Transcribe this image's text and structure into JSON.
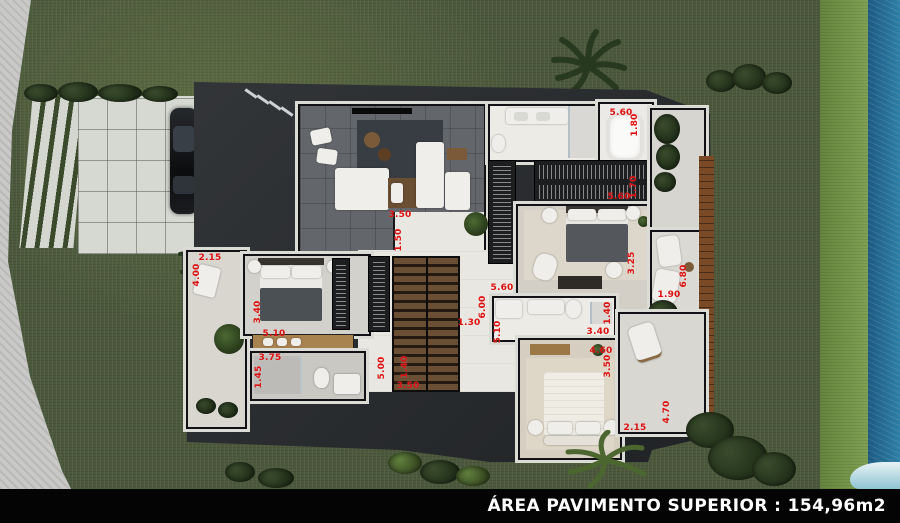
{
  "scene": {
    "description": "Top-down 3D architectural render of an upper-floor house plan with garden, driveway, parked car, wooden deck and pool"
  },
  "footer": {
    "area_label": "ÁREA PAVIMENTO SUPERIOR : 154,96m2"
  },
  "palette": {
    "grass": "#4c593c",
    "strip_green": "#7fa04f",
    "water": "#2e7fa6",
    "water_deep": "#1d5a82",
    "driveway": "#d6d8d2",
    "roof": "#26292c",
    "wood": "#7a4a26",
    "label_red": "#dd1111"
  },
  "dimensions": [
    {
      "label": "3.50",
      "x": 400,
      "y": 215,
      "vertical": false
    },
    {
      "label": "1.50",
      "x": 399,
      "y": 240,
      "vertical": true
    },
    {
      "label": "2.15",
      "x": 210,
      "y": 258,
      "vertical": false
    },
    {
      "label": "4.00",
      "x": 197,
      "y": 275,
      "vertical": true
    },
    {
      "label": "3.40",
      "x": 258,
      "y": 312,
      "vertical": true
    },
    {
      "label": "5.10",
      "x": 274,
      "y": 334,
      "vertical": false
    },
    {
      "label": "3.75",
      "x": 270,
      "y": 358,
      "vertical": false
    },
    {
      "label": "1.45",
      "x": 259,
      "y": 377,
      "vertical": true
    },
    {
      "label": "5.00",
      "x": 382,
      "y": 368,
      "vertical": true
    },
    {
      "label": "1.40",
      "x": 405,
      "y": 367,
      "vertical": true
    },
    {
      "label": "3.50",
      "x": 408,
      "y": 386,
      "vertical": false
    },
    {
      "label": "5.60",
      "x": 502,
      "y": 288,
      "vertical": false
    },
    {
      "label": "6.00",
      "x": 483,
      "y": 307,
      "vertical": true
    },
    {
      "label": "1.30",
      "x": 469,
      "y": 323,
      "vertical": false
    },
    {
      "label": "5.10",
      "x": 498,
      "y": 332,
      "vertical": true
    },
    {
      "label": "5.60",
      "x": 621,
      "y": 113,
      "vertical": false
    },
    {
      "label": "1.80",
      "x": 635,
      "y": 125,
      "vertical": true
    },
    {
      "label": "1.70",
      "x": 634,
      "y": 187,
      "vertical": true
    },
    {
      "label": "5.60",
      "x": 619,
      "y": 197,
      "vertical": false
    },
    {
      "label": "3.25",
      "x": 632,
      "y": 263,
      "vertical": true
    },
    {
      "label": "6.80",
      "x": 684,
      "y": 276,
      "vertical": true
    },
    {
      "label": "1.90",
      "x": 669,
      "y": 295,
      "vertical": false
    },
    {
      "label": "1.40",
      "x": 608,
      "y": 313,
      "vertical": true
    },
    {
      "label": "3.40",
      "x": 598,
      "y": 332,
      "vertical": false
    },
    {
      "label": "4.60",
      "x": 601,
      "y": 351,
      "vertical": false
    },
    {
      "label": "3.50",
      "x": 608,
      "y": 366,
      "vertical": true
    },
    {
      "label": "2.15",
      "x": 635,
      "y": 428,
      "vertical": false
    },
    {
      "label": "4.70",
      "x": 667,
      "y": 412,
      "vertical": true
    }
  ]
}
